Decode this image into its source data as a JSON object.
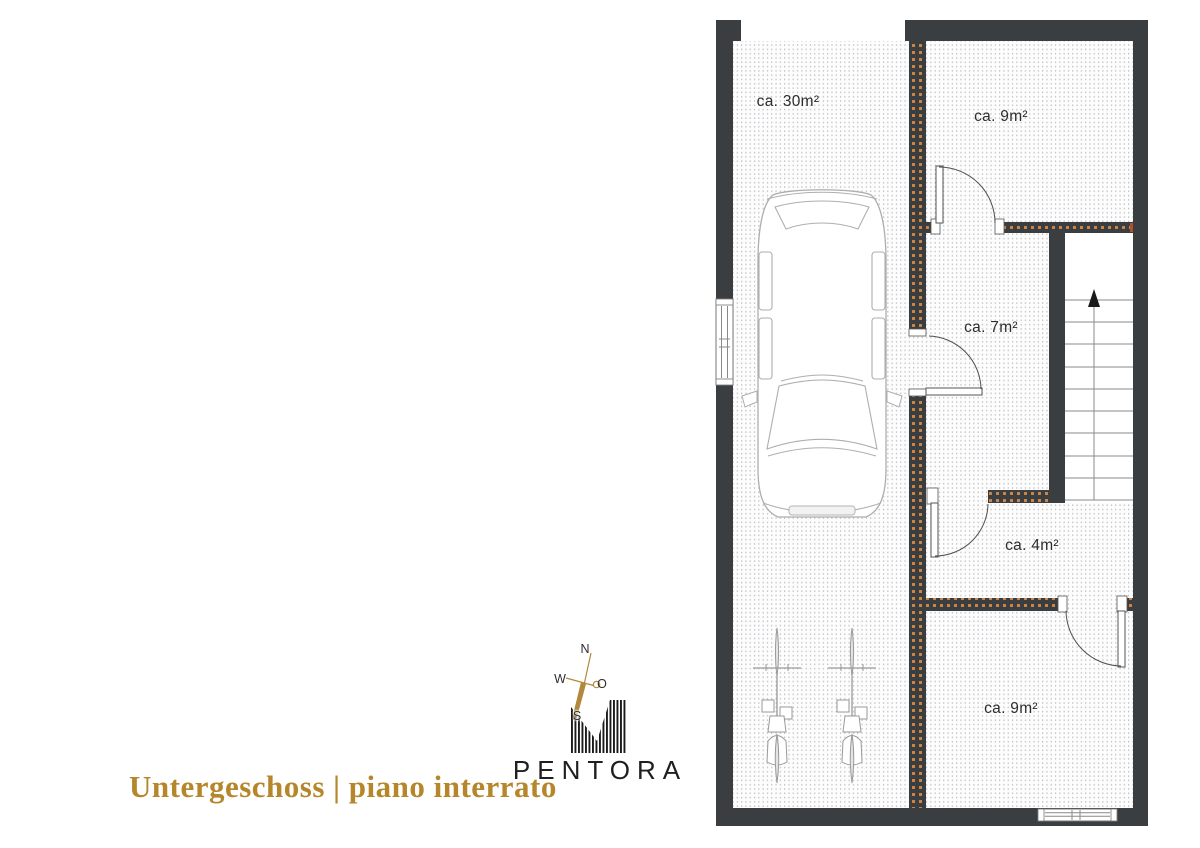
{
  "plan": {
    "floor_title": "Untergeschoss | piano interrato",
    "rooms": {
      "garage": {
        "area_label": "ca. 30m²"
      },
      "cellar_top": {
        "area_label": "ca. 9m²"
      },
      "hall": {
        "area_label": "ca. 7m²"
      },
      "cellar_small": {
        "area_label": "ca. 4m²"
      },
      "cellar_bottom": {
        "area_label": "ca. 9m²"
      }
    }
  },
  "compass": {
    "north": "N",
    "east": "O",
    "south": "S",
    "west": "W"
  },
  "brand": {
    "wordmark": "PENTORA"
  },
  "colors": {
    "wall": "#3b3e40",
    "wall_hatch_dot": "#ce8644",
    "floor_dot": "#bdbdc1",
    "door_line": "#4f4f4f",
    "stair_line": "#8a8a8a",
    "vehicle_line": "#aeaeae",
    "label_ink": "#2d2d2d",
    "title_gold": "#b5862a",
    "compass_gold": "#b2883c",
    "logo_ink": "#1b1b1b"
  }
}
